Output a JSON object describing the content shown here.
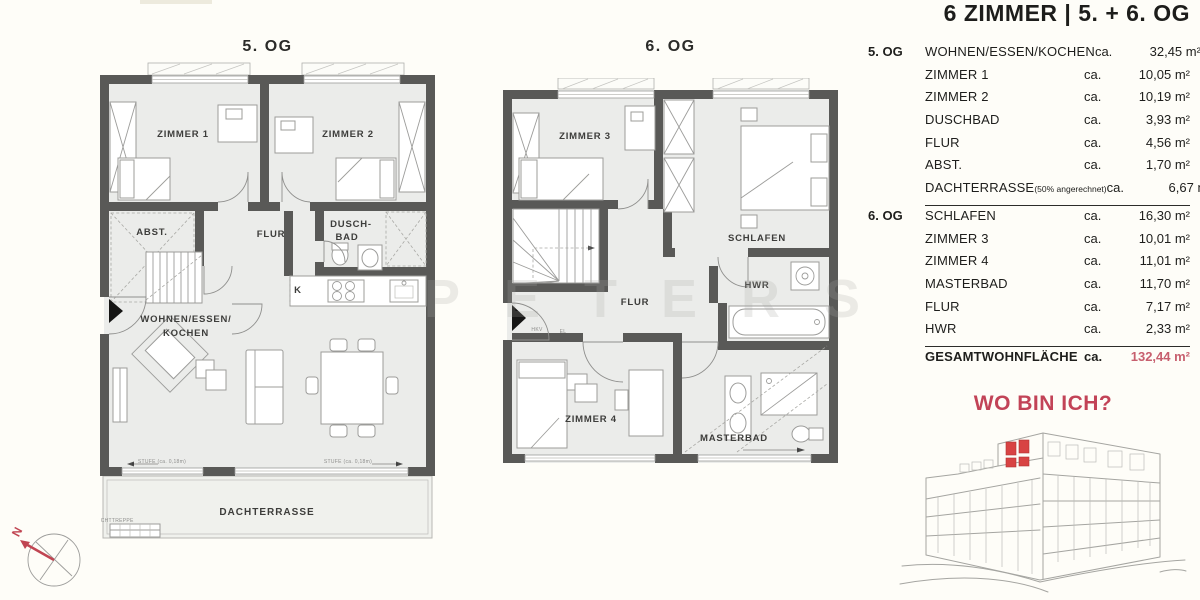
{
  "header": {
    "title": "6 ZIMMER | 5. + 6. OG"
  },
  "plans": {
    "og5": {
      "title": "5. OG",
      "labels": {
        "zimmer1": "ZIMMER 1",
        "zimmer2": "ZIMMER 2",
        "abst": "ABST.",
        "flur": "FLUR",
        "dusch1": "DUSCH-",
        "dusch2": "BAD",
        "k": "K",
        "wohnen1": "WOHNEN/ESSEN/",
        "wohnen2": "KOCHEN",
        "stufe": "STUFE (ca. 0,18m)",
        "dachterrasse": "DACHTERRASSE",
        "fluchttreppe": "FLUCHTTREPPE"
      }
    },
    "og6": {
      "title": "6. OG",
      "labels": {
        "zimmer3": "ZIMMER 3",
        "schlafen": "SCHLAFEN",
        "flur": "FLUR",
        "hwr": "HWR",
        "hkv": "HKV",
        "el": "EL",
        "zimmer4": "ZIMMER 4",
        "masterbad": "MASTERBAD"
      }
    }
  },
  "area_table": {
    "sections": [
      {
        "floor": "5. OG",
        "rows": [
          {
            "room": "WOHNEN/ESSEN/KOCHEN",
            "ca": "ca.",
            "value": "32,45 m²",
            "note": ""
          },
          {
            "room": "ZIMMER 1",
            "ca": "ca.",
            "value": "10,05 m²",
            "note": ""
          },
          {
            "room": "ZIMMER 2",
            "ca": "ca.",
            "value": "10,19 m²",
            "note": ""
          },
          {
            "room": "DUSCHBAD",
            "ca": "ca.",
            "value": "3,93 m²",
            "note": ""
          },
          {
            "room": "FLUR",
            "ca": "ca.",
            "value": "4,56 m²",
            "note": ""
          },
          {
            "room": "ABST.",
            "ca": "ca.",
            "value": "1,70 m²",
            "note": ""
          },
          {
            "room": "DACHTERRASSE",
            "ca": "ca.",
            "value": "6,67 m²",
            "note": "(50% angerechnet)"
          }
        ]
      },
      {
        "floor": "6. OG",
        "rows": [
          {
            "room": "SCHLAFEN",
            "ca": "ca.",
            "value": "16,30 m²",
            "note": ""
          },
          {
            "room": "ZIMMER 3",
            "ca": "ca.",
            "value": "10,01 m²",
            "note": ""
          },
          {
            "room": "ZIMMER 4",
            "ca": "ca.",
            "value": "11,01 m²",
            "note": ""
          },
          {
            "room": "MASTERBAD",
            "ca": "ca.",
            "value": "11,70 m²",
            "note": ""
          },
          {
            "room": "FLUR",
            "ca": "ca.",
            "value": "7,17 m²",
            "note": ""
          },
          {
            "room": "HWR",
            "ca": "ca.",
            "value": "2,33 m²",
            "note": ""
          }
        ]
      }
    ],
    "total": {
      "label": "GESAMTWOHNFLÄCHE",
      "ca": "ca.",
      "value": "132,44 m²"
    }
  },
  "locator": {
    "title": "WO BIN ICH?"
  },
  "compass": {
    "north": "N"
  },
  "watermark": {
    "text": "PETERS"
  },
  "colors": {
    "accent_red": "#c24357",
    "total_red": "#c75f6e",
    "highlight_red": "#d84343",
    "wall_gray": "#595957",
    "floor_gray": "#ebecea"
  }
}
